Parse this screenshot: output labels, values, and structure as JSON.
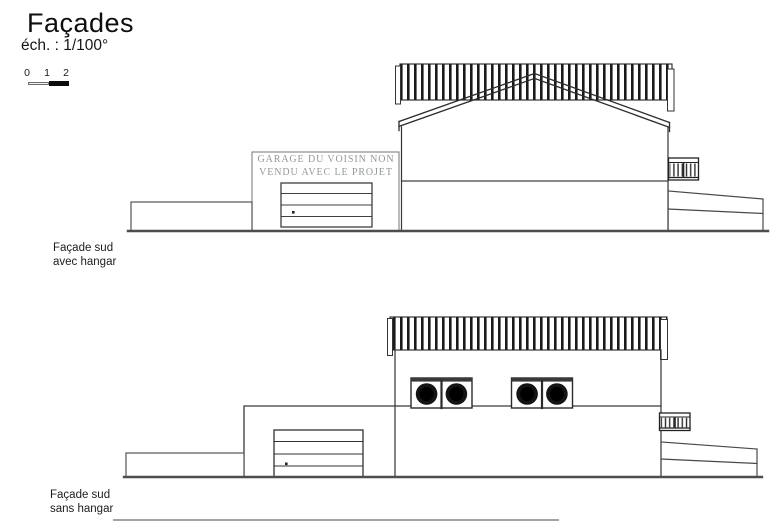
{
  "header": {
    "title": "Façades",
    "scale_label": "éch. : 1/100°"
  },
  "scale_bar": {
    "ticks": [
      "0",
      "1",
      "2"
    ]
  },
  "drawings": [
    {
      "id": "facade-sud-avec-hangar",
      "label_line1": "Façade sud",
      "label_line2": "avec hangar",
      "annotation_line1": "GARAGE DU VOISIN NON",
      "annotation_line2": "VENDU AVEC LE PROJET"
    },
    {
      "id": "facade-sud-sans-hangar",
      "label_line1": "Façade sud",
      "label_line2": "sans hangar"
    }
  ],
  "colors": {
    "background": "#ffffff",
    "line": "#2e2e2e",
    "ground": "#4d4d4d",
    "neighbor_garage_outline": "#8c8c8c",
    "annotation_text": "#939896",
    "roof_hatch": "#1a1a1a",
    "window_fill": "#0d0d0d"
  }
}
